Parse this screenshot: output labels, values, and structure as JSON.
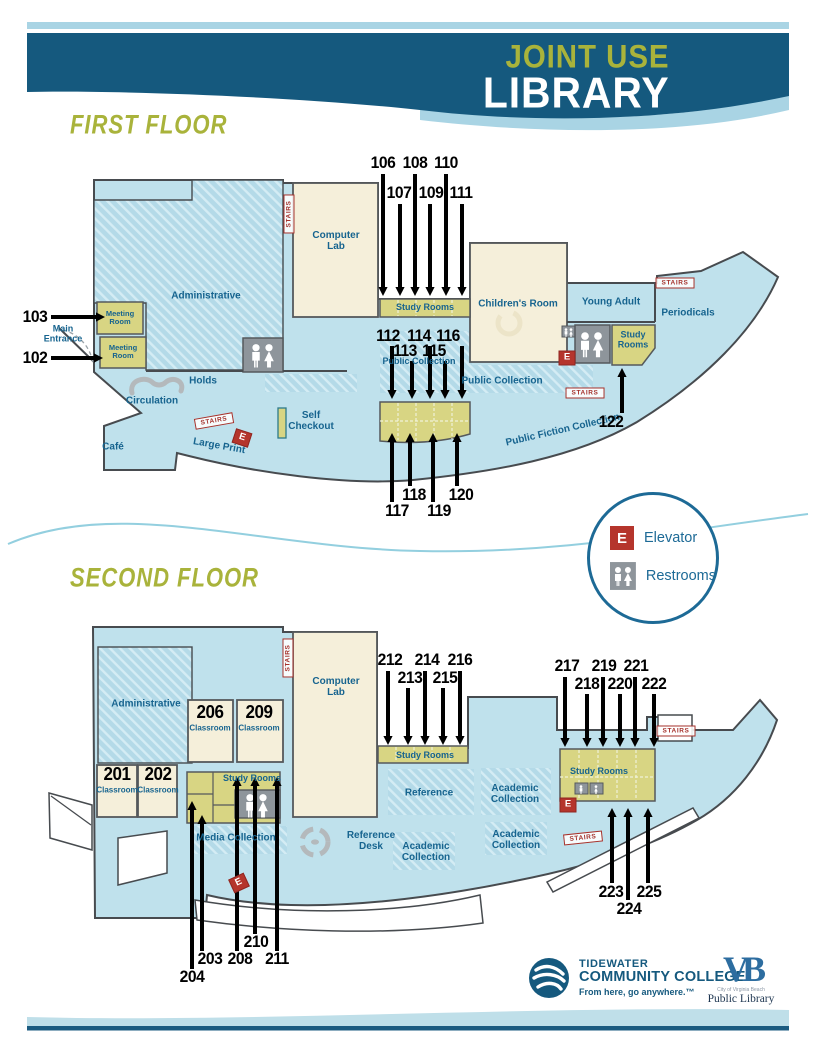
{
  "header": {
    "title_line1": "JOINT USE",
    "title_line2": "LIBRARY"
  },
  "legend": {
    "elevator_symbol": "E",
    "elevator_label": "Elevator",
    "restrooms_label": "Restrooms"
  },
  "footer": {
    "tcc_name_line1": "TIDEWATER",
    "tcc_name_line2": "COMMUNITY COLLEGE",
    "tcc_tagline": "From here, go anywhere.™",
    "vb_monogram": "VB",
    "vb_city": "City of Virginia Beach",
    "vb_name": "Public Library"
  },
  "colors": {
    "banner_blue": "#15597e",
    "stripe_blue": "#a9d4e4",
    "olive_text": "#a9b33b",
    "map_blue": "#bfe1ec",
    "room_cream": "#f5efda",
    "room_olive": "#d8d583",
    "label_blue": "#17648f",
    "alert_red": "#b5352c",
    "wc_gray": "#8e959b"
  },
  "floors": [
    {
      "title": "FIRST FLOOR",
      "labels": [
        {
          "t": "Administrative",
          "x": 191,
          "y": 147,
          "c": "area"
        },
        {
          "t": "Meeting Room",
          "x": 105,
          "y": 168,
          "c": "area xs",
          "w": 36
        },
        {
          "t": "Meeting Room",
          "x": 108,
          "y": 202,
          "c": "area xs",
          "w": 36
        },
        {
          "t": "Computer Lab",
          "x": 321,
          "y": 92,
          "c": "area",
          "w": 58
        },
        {
          "t": "Study Rooms",
          "x": 410,
          "y": 158,
          "c": "area sm"
        },
        {
          "t": "Children's Room",
          "x": 503,
          "y": 155,
          "c": "area"
        },
        {
          "t": "Young Adult",
          "x": 596,
          "y": 153,
          "c": "area"
        },
        {
          "t": "Periodicals",
          "x": 673,
          "y": 164,
          "c": "area"
        },
        {
          "t": "Study Rooms",
          "x": 618,
          "y": 190,
          "c": "area sm",
          "w": 42
        },
        {
          "t": "Public Collection",
          "x": 404,
          "y": 212,
          "c": "area sm"
        },
        {
          "t": "Public Collection",
          "x": 487,
          "y": 232,
          "c": "area"
        },
        {
          "t": "Public Fiction Collection",
          "x": 548,
          "y": 281,
          "c": "area",
          "r": -13
        },
        {
          "t": "Holds",
          "x": 188,
          "y": 232,
          "c": "area"
        },
        {
          "t": "Circulation",
          "x": 137,
          "y": 252,
          "c": "area"
        },
        {
          "t": "Café",
          "x": 98,
          "y": 298,
          "c": "area"
        },
        {
          "t": "Large Print",
          "x": 204,
          "y": 297,
          "c": "area",
          "r": 10
        },
        {
          "t": "Self Checkout",
          "x": 296,
          "y": 272,
          "c": "area",
          "w": 48
        },
        {
          "t": "Main Entrance",
          "x": 48,
          "y": 184,
          "c": "area sm",
          "w": 50
        },
        {
          "t": "103",
          "x": 20,
          "y": 167,
          "c": "num"
        },
        {
          "t": "102",
          "x": 20,
          "y": 208,
          "c": "num"
        },
        {
          "t": "106",
          "x": 368,
          "y": 13,
          "c": "num"
        },
        {
          "t": "108",
          "x": 400,
          "y": 13,
          "c": "num"
        },
        {
          "t": "110",
          "x": 431,
          "y": 13,
          "c": "num"
        },
        {
          "t": "107",
          "x": 384,
          "y": 43,
          "c": "num"
        },
        {
          "t": "109",
          "x": 416,
          "y": 43,
          "c": "num"
        },
        {
          "t": "111",
          "x": 446,
          "y": 43,
          "c": "num"
        },
        {
          "t": "112",
          "x": 373,
          "y": 186,
          "c": "num"
        },
        {
          "t": "114",
          "x": 404,
          "y": 186,
          "c": "num"
        },
        {
          "t": "116",
          "x": 433,
          "y": 186,
          "c": "num"
        },
        {
          "t": "113",
          "x": 390,
          "y": 201,
          "c": "num"
        },
        {
          "t": "115",
          "x": 419,
          "y": 201,
          "c": "num"
        },
        {
          "t": "117",
          "x": 382,
          "y": 361,
          "c": "num"
        },
        {
          "t": "118",
          "x": 399,
          "y": 345,
          "c": "num"
        },
        {
          "t": "119",
          "x": 424,
          "y": 361,
          "c": "num"
        },
        {
          "t": "120",
          "x": 446,
          "y": 345,
          "c": "num"
        },
        {
          "t": "122",
          "x": 596,
          "y": 272,
          "c": "num"
        },
        {
          "t": "STAIRS",
          "x": 274,
          "y": 64,
          "c": "stairs",
          "r": -90
        },
        {
          "t": "STAIRS",
          "x": 199,
          "y": 271,
          "c": "stairs",
          "r": -10
        },
        {
          "t": "STAIRS",
          "x": 570,
          "y": 243,
          "c": "stairs"
        },
        {
          "t": "STAIRS",
          "x": 660,
          "y": 133,
          "c": "stairs"
        },
        {
          "t": "E",
          "x": 552,
          "y": 208,
          "c": "ebox"
        },
        {
          "t": "E",
          "x": 227,
          "y": 288,
          "c": "ebox",
          "r": 18
        }
      ],
      "arrows": [
        [
          36,
          167,
          90,
          167
        ],
        [
          36,
          208,
          88,
          208
        ],
        [
          368,
          24,
          368,
          146
        ],
        [
          385,
          54,
          385,
          146
        ],
        [
          400,
          24,
          400,
          146
        ],
        [
          415,
          54,
          415,
          146
        ],
        [
          431,
          24,
          431,
          146
        ],
        [
          447,
          54,
          447,
          146
        ],
        [
          377,
          196,
          377,
          249
        ],
        [
          397,
          211,
          397,
          249
        ],
        [
          415,
          196,
          415,
          249
        ],
        [
          430,
          211,
          430,
          249
        ],
        [
          447,
          196,
          447,
          249
        ],
        [
          377,
          352,
          377,
          283
        ],
        [
          395,
          336,
          395,
          283
        ],
        [
          418,
          352,
          418,
          283
        ],
        [
          442,
          336,
          442,
          283
        ],
        [
          607,
          263,
          607,
          218
        ]
      ]
    },
    {
      "title": "SECOND FLOOR",
      "labels": [
        {
          "t": "Administrative",
          "x": 131,
          "y": 150,
          "c": "area"
        },
        {
          "t": "206",
          "x": 195,
          "y": 157,
          "c": "num lg"
        },
        {
          "t": "Classroom",
          "x": 195,
          "y": 174,
          "c": "area cap"
        },
        {
          "t": "209",
          "x": 244,
          "y": 157,
          "c": "num lg"
        },
        {
          "t": "Classroom",
          "x": 244,
          "y": 174,
          "c": "area cap"
        },
        {
          "t": "201",
          "x": 102,
          "y": 219,
          "c": "num lg"
        },
        {
          "t": "Classroom",
          "x": 102,
          "y": 236,
          "c": "area cap"
        },
        {
          "t": "202",
          "x": 143,
          "y": 219,
          "c": "num lg"
        },
        {
          "t": "Classroom",
          "x": 143,
          "y": 236,
          "c": "area cap"
        },
        {
          "t": "Computer Lab",
          "x": 321,
          "y": 133,
          "c": "area",
          "w": 58
        },
        {
          "t": "Study Rooms",
          "x": 237,
          "y": 224,
          "c": "area sm"
        },
        {
          "t": "Media Collection",
          "x": 221,
          "y": 284,
          "c": "area"
        },
        {
          "t": "Reference Desk",
          "x": 356,
          "y": 287,
          "c": "area",
          "w": 60
        },
        {
          "t": "Study Rooms",
          "x": 410,
          "y": 201,
          "c": "area sm"
        },
        {
          "t": "Reference",
          "x": 414,
          "y": 239,
          "c": "area"
        },
        {
          "t": "Academic Collection",
          "x": 500,
          "y": 240,
          "c": "area",
          "w": 64
        },
        {
          "t": "Academic Collection",
          "x": 411,
          "y": 298,
          "c": "area",
          "w": 64
        },
        {
          "t": "Academic Collection",
          "x": 501,
          "y": 286,
          "c": "area",
          "w": 64
        },
        {
          "t": "Study Rooms",
          "x": 584,
          "y": 217,
          "c": "area sm"
        },
        {
          "t": "212",
          "x": 375,
          "y": 105,
          "c": "num"
        },
        {
          "t": "214",
          "x": 412,
          "y": 105,
          "c": "num"
        },
        {
          "t": "216",
          "x": 445,
          "y": 105,
          "c": "num"
        },
        {
          "t": "213",
          "x": 395,
          "y": 123,
          "c": "num"
        },
        {
          "t": "215",
          "x": 430,
          "y": 123,
          "c": "num"
        },
        {
          "t": "217",
          "x": 552,
          "y": 111,
          "c": "num"
        },
        {
          "t": "219",
          "x": 589,
          "y": 111,
          "c": "num"
        },
        {
          "t": "221",
          "x": 621,
          "y": 111,
          "c": "num"
        },
        {
          "t": "218",
          "x": 572,
          "y": 129,
          "c": "num"
        },
        {
          "t": "220",
          "x": 605,
          "y": 129,
          "c": "num"
        },
        {
          "t": "222",
          "x": 639,
          "y": 129,
          "c": "num"
        },
        {
          "t": "223",
          "x": 596,
          "y": 337,
          "c": "num"
        },
        {
          "t": "225",
          "x": 634,
          "y": 337,
          "c": "num"
        },
        {
          "t": "224",
          "x": 614,
          "y": 354,
          "c": "num"
        },
        {
          "t": "210",
          "x": 241,
          "y": 387,
          "c": "num"
        },
        {
          "t": "203",
          "x": 195,
          "y": 404,
          "c": "num"
        },
        {
          "t": "208",
          "x": 225,
          "y": 404,
          "c": "num"
        },
        {
          "t": "211",
          "x": 262,
          "y": 404,
          "c": "num"
        },
        {
          "t": "204",
          "x": 177,
          "y": 422,
          "c": "num"
        },
        {
          "t": "STAIRS",
          "x": 273,
          "y": 103,
          "c": "stairs",
          "r": -90
        },
        {
          "t": "STAIRS",
          "x": 661,
          "y": 176,
          "c": "stairs"
        },
        {
          "t": "STAIRS",
          "x": 568,
          "y": 283,
          "c": "stairs",
          "r": -6
        },
        {
          "t": "E",
          "x": 553,
          "y": 250,
          "c": "ebox"
        },
        {
          "t": "E",
          "x": 224,
          "y": 328,
          "c": "ebox",
          "r": -25
        }
      ],
      "arrows": [
        [
          373,
          116,
          373,
          190
        ],
        [
          393,
          133,
          393,
          190
        ],
        [
          410,
          116,
          410,
          190
        ],
        [
          428,
          133,
          428,
          190
        ],
        [
          445,
          116,
          445,
          190
        ],
        [
          550,
          122,
          550,
          192
        ],
        [
          572,
          139,
          572,
          192
        ],
        [
          588,
          122,
          588,
          192
        ],
        [
          605,
          139,
          605,
          192
        ],
        [
          620,
          122,
          620,
          192
        ],
        [
          639,
          139,
          639,
          192
        ],
        [
          597,
          328,
          597,
          253
        ],
        [
          613,
          345,
          613,
          253
        ],
        [
          633,
          328,
          633,
          253
        ],
        [
          187,
          396,
          187,
          260
        ],
        [
          177,
          414,
          177,
          246
        ],
        [
          222,
          396,
          222,
          222
        ],
        [
          240,
          379,
          240,
          222
        ],
        [
          262,
          396,
          262,
          222
        ]
      ]
    }
  ]
}
